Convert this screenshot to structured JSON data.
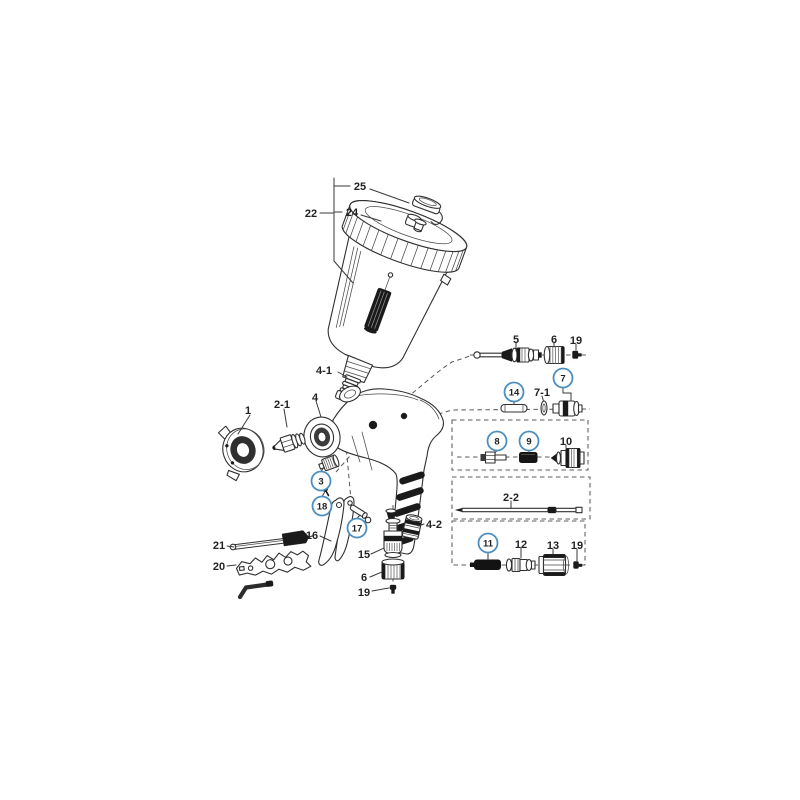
{
  "canvas": {
    "background": "#ffffff"
  },
  "colors": {
    "line": "#303030",
    "dark_fill": "#1a1a1a",
    "dashed_line": "#5d5d5d",
    "callout_circle": "#4a8fc0",
    "label_text": "#232323"
  },
  "callouts": [
    {
      "id": "cup-assembly",
      "label": "22",
      "circled": false
    },
    {
      "id": "cup-lid",
      "label": "24",
      "circled": false
    },
    {
      "id": "vent-cap",
      "label": "25",
      "circled": false
    },
    {
      "id": "cup-connector",
      "label": "4-1",
      "circled": false
    },
    {
      "id": "gun-body",
      "label": "4",
      "circled": false
    },
    {
      "id": "air-cap",
      "label": "1",
      "circled": false
    },
    {
      "id": "fluid-nozzle",
      "label": "2-1",
      "circled": false
    },
    {
      "id": "nozzle-fitting",
      "label": "3",
      "circled": true
    },
    {
      "id": "trigger-screw",
      "label": "18",
      "circled": true
    },
    {
      "id": "trigger-pin",
      "label": "17",
      "circled": true
    },
    {
      "id": "trigger",
      "label": "16",
      "circled": false
    },
    {
      "id": "cleaning-brush",
      "label": "21",
      "circled": false
    },
    {
      "id": "wrench-tool",
      "label": "20",
      "circled": false
    },
    {
      "id": "air-valve-assembly",
      "label": "15",
      "circled": false
    },
    {
      "id": "valve-knob-bottom",
      "label": "6",
      "circled": false
    },
    {
      "id": "valve-screw-bottom",
      "label": "19",
      "circled": false
    },
    {
      "id": "inlet-fitting",
      "label": "4-2",
      "circled": false
    },
    {
      "id": "needle-set",
      "label": "5",
      "circled": false
    },
    {
      "id": "adjust-knob-top",
      "label": "6",
      "circled": false
    },
    {
      "id": "screw-top",
      "label": "19",
      "circled": false
    },
    {
      "id": "pin",
      "label": "14",
      "circled": true
    },
    {
      "id": "valve-seal",
      "label": "7-1",
      "circled": false
    },
    {
      "id": "air-valve",
      "label": "7",
      "circled": true
    },
    {
      "id": "rod",
      "label": "8",
      "circled": true
    },
    {
      "id": "spring-small",
      "label": "9",
      "circled": true
    },
    {
      "id": "valve-set",
      "label": "10",
      "circled": false
    },
    {
      "id": "fluid-needle",
      "label": "2-2",
      "circled": false
    },
    {
      "id": "spring-dark",
      "label": "11",
      "circled": true
    },
    {
      "id": "piston",
      "label": "12",
      "circled": false
    },
    {
      "id": "knob-large",
      "label": "13",
      "circled": false
    },
    {
      "id": "screw-bottom-right",
      "label": "19",
      "circled": false
    }
  ]
}
